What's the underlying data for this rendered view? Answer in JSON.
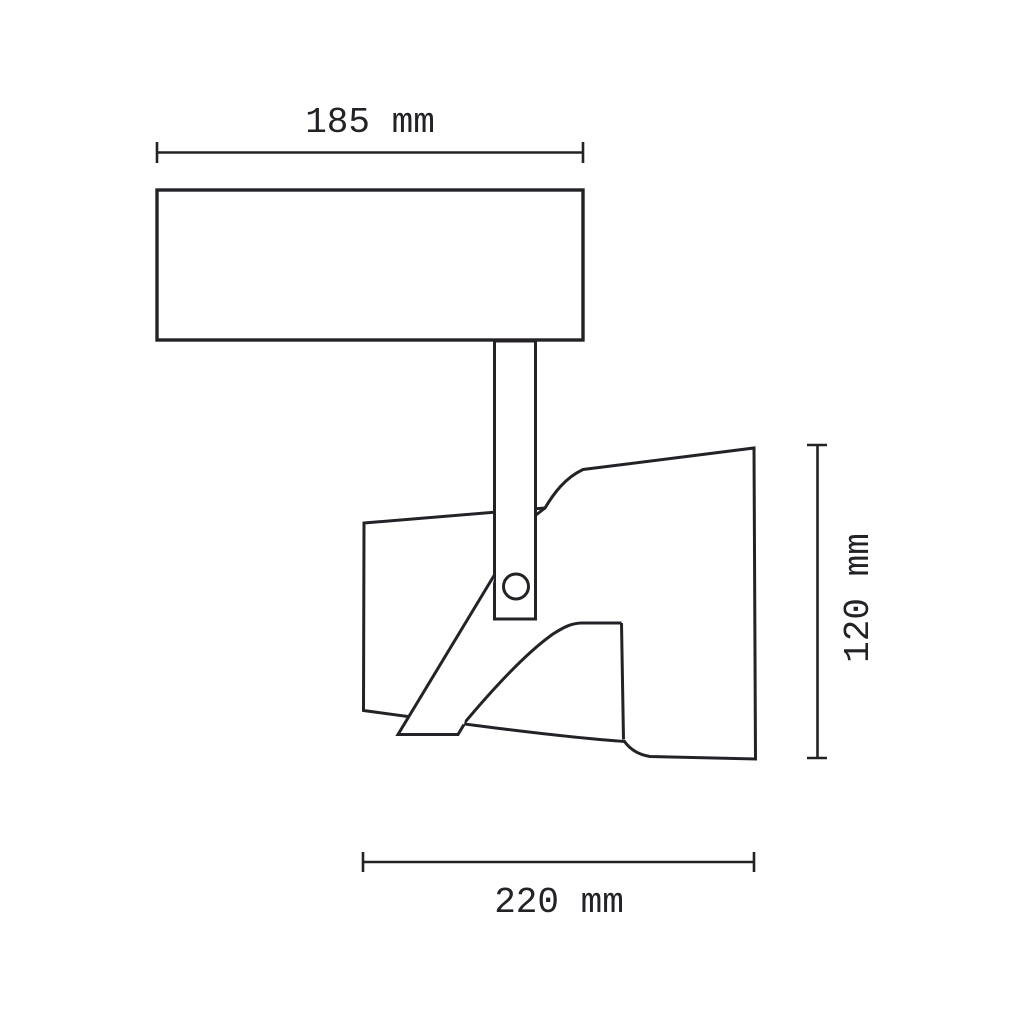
{
  "page": {
    "background": "#ffffff"
  },
  "drawing": {
    "kind": "technical-dimension-drawing",
    "subject": "spotlight-fixture-side-view",
    "line_color": "#242226",
    "labels": {
      "width": "185 mm",
      "depth": "220 mm",
      "height": "120 mm"
    },
    "values": {
      "width_mm": 185,
      "depth_mm": 220,
      "height_mm": 120,
      "unit": "mm"
    }
  }
}
